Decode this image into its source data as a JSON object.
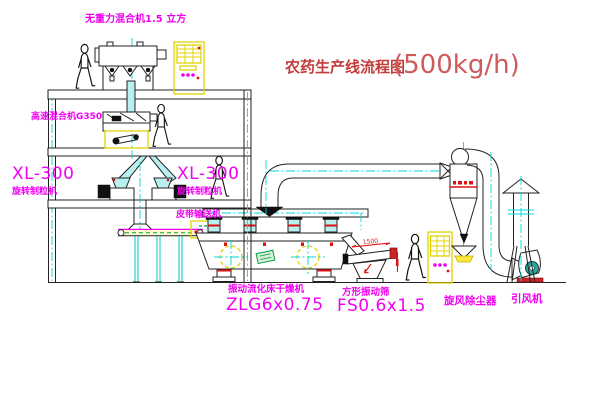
{
  "diagram": {
    "title": "农药生产线流程图",
    "capacity": "(500kg/h)"
  },
  "equipment": {
    "gravity_mixer": {
      "label": "无重力混合机1.5 立方"
    },
    "high_speed_mixer": {
      "label": "高速混合机G350"
    },
    "granulator_left": {
      "model": "XL-300",
      "name": "旋转制粒机"
    },
    "granulator_right": {
      "model": "XL-300",
      "name": "旋转制粒机"
    },
    "belt_conveyor": {
      "name": "皮带输送机"
    },
    "fluid_bed_dryer": {
      "name": "振动流化床干燥机",
      "model": "ZLG6x0.75"
    },
    "vibrating_screen": {
      "name": "方形振动筛",
      "model": "FS0.6x1.5",
      "dimension": "1500"
    },
    "cyclone": {
      "name": "旋风除尘器"
    },
    "induced_draft_fan": {
      "name": "引风机"
    }
  },
  "colors": {
    "label_magenta": "#f200f2",
    "title_red": "#c43b3b",
    "centerline_cyan": "#00d8d8",
    "highlight_yellow": "#ffe93e",
    "accent_red": "#dd1111",
    "accent_green": "#00a044",
    "line_black": "#222222"
  }
}
